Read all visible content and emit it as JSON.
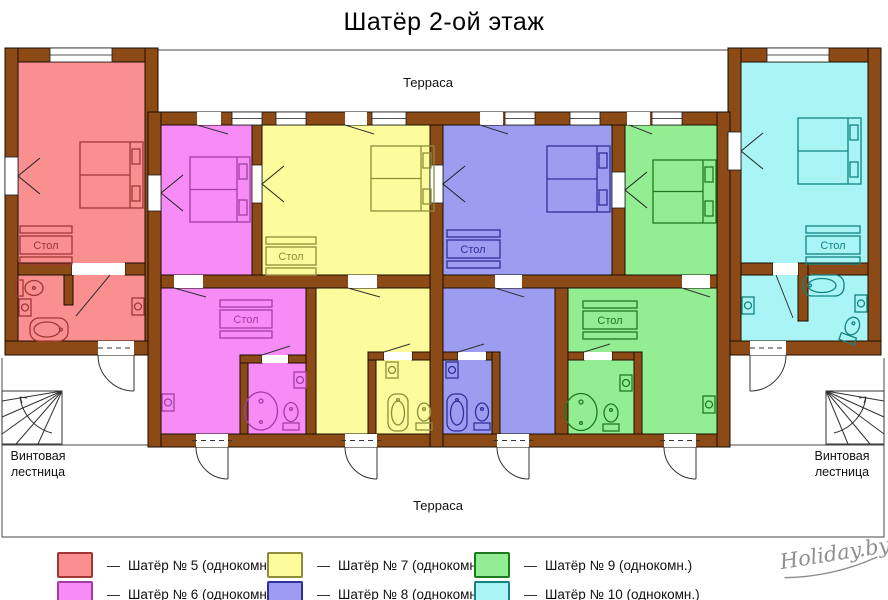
{
  "title": "Шатёр 2-ой этаж",
  "plan": {
    "terrace_top_label": "Терраса",
    "terrace_bottom_label": "Терраса",
    "table_label": "Стол",
    "stairs_left_line1": "Винтовая",
    "stairs_left_line2": "лестница",
    "stairs_right_line1": "Винтовая",
    "stairs_right_line2": "лестница"
  },
  "colors": {
    "wall": "#8C4A16",
    "wall_outline": "#1A0D00",
    "plan_line": "#3A3A3A"
  },
  "rooms": [
    {
      "number": "5",
      "legend_label": "Шатёр № 5 (однокомн.)",
      "fill": "#FA8F8F",
      "line": "#A03636"
    },
    {
      "number": "6",
      "legend_label": "Шатёр № 6 (однокомн.)",
      "fill": "#F78CF7",
      "line": "#A23EA2"
    },
    {
      "number": "7",
      "legend_label": "Шатёр № 7 (однокомн.)",
      "fill": "#FCFC9C",
      "line": "#8C8C3A"
    },
    {
      "number": "8",
      "legend_label": "Шатёр № 8 (однокомн.)",
      "fill": "#9C9CF0",
      "line": "#30309A"
    },
    {
      "number": "9",
      "legend_label": "Шатёр № 9 (однокомн.)",
      "fill": "#93EE93",
      "line": "#1F7A1F"
    },
    {
      "number": "10",
      "legend_label": "Шатёр № 10 (однокомн.)",
      "fill": "#A9F4F4",
      "line": "#138383"
    }
  ],
  "legend": {
    "dash": "—"
  },
  "logo": {
    "text": "Holiday.by"
  }
}
